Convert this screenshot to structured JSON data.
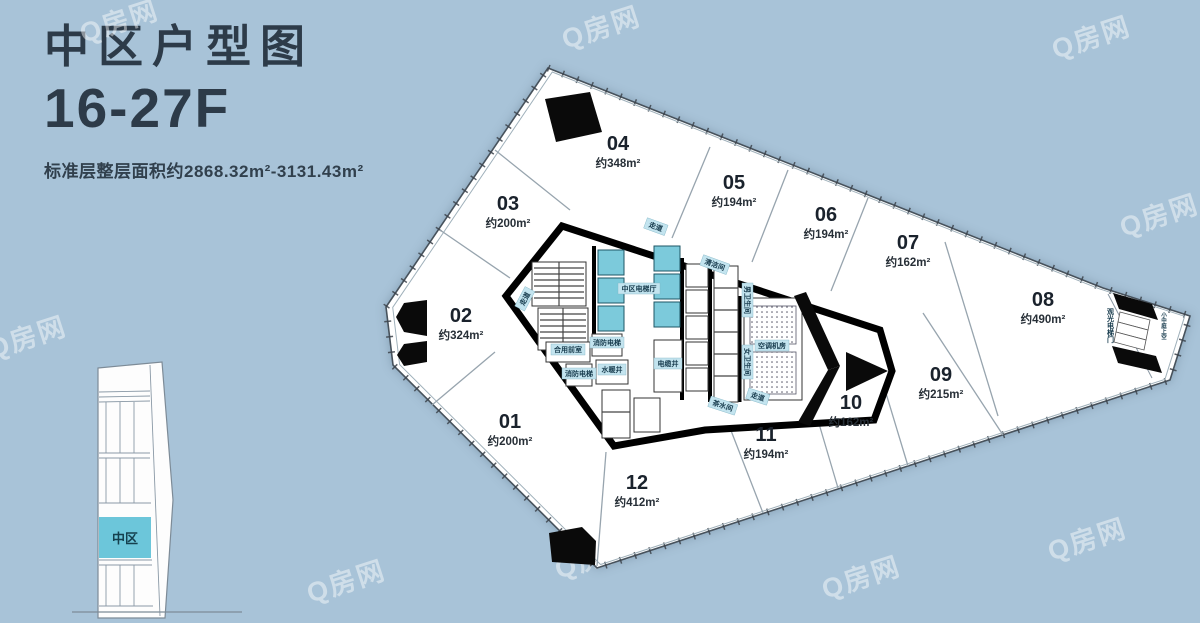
{
  "header": {
    "title": "中区户型图",
    "floors": "16-27F",
    "area_note": "标准层整层面积约2868.32m²-3131.43m²"
  },
  "watermark": {
    "text": "Q房网"
  },
  "plan": {
    "units": [
      {
        "no": "01",
        "area": "约200m²"
      },
      {
        "no": "02",
        "area": "约324m²"
      },
      {
        "no": "03",
        "area": "约200m²"
      },
      {
        "no": "04",
        "area": "约348m²"
      },
      {
        "no": "05",
        "area": "约194m²"
      },
      {
        "no": "06",
        "area": "约194m²"
      },
      {
        "no": "07",
        "area": "约162m²"
      },
      {
        "no": "08",
        "area": "约490m²"
      },
      {
        "no": "09",
        "area": "约215m²"
      },
      {
        "no": "10",
        "area": "约162m²"
      },
      {
        "no": "11",
        "area": "约194m²"
      },
      {
        "no": "12",
        "area": "约412m²"
      }
    ],
    "core_labels": [
      {
        "text": "走道"
      },
      {
        "text": "走道"
      },
      {
        "text": "清洁间"
      },
      {
        "text": "中区电梯厅"
      },
      {
        "text": "合用前室"
      },
      {
        "text": "消防电梯"
      },
      {
        "text": "消防电梯"
      },
      {
        "text": "水暖井"
      },
      {
        "text": "电缆井"
      },
      {
        "text": "男卫生间"
      },
      {
        "text": "女卫生间"
      },
      {
        "text": "空调机房"
      },
      {
        "text": "茶水间"
      },
      {
        "text": "走道"
      }
    ],
    "tip_labels": [
      {
        "text": "观光电梯门"
      },
      {
        "text": "小中庭上空"
      }
    ]
  },
  "building": {
    "zone": "中区"
  },
  "colors": {
    "background": "#a8c3d8",
    "ink": "#2d3b49",
    "elevator_cyan": "#7ccadb",
    "zone_cyan": "#6cc6da",
    "chip": "#c3e4ef",
    "plan_white": "#ffffff",
    "wall_black": "#000000"
  }
}
